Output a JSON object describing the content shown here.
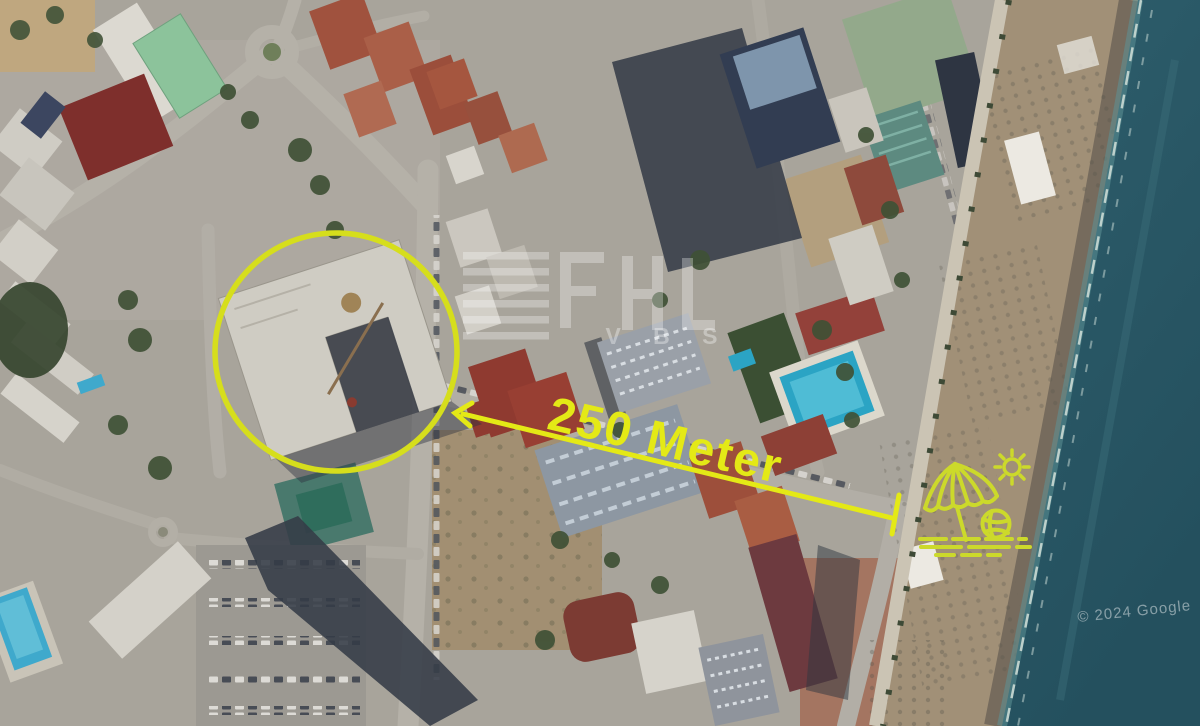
{
  "map": {
    "type": "satellite-aerial-photo",
    "description": "Aerial view of a coastal town: urban blocks left, beach and sea on the right",
    "annotations": {
      "distance_label": "250 Meter",
      "highlight_circle": {
        "purpose": "highlighted building under construction",
        "center_x": 336,
        "center_y": 352,
        "radius": 120
      },
      "beach_icons": [
        "umbrella-icon",
        "sun-icon",
        "beach-ball-icon",
        "sand-lines-icon"
      ],
      "watermark_small_text": "V B S",
      "copyright": "© 2024 Google"
    },
    "colors": {
      "annotation_yellow": "#e4e916",
      "circle_yellow": "#d6de1c",
      "icon_yellow": "#ccd92b",
      "ocean": "#2e5e6c",
      "ocean_deep": "#24505e",
      "surf": "#5d9196",
      "sand": "#a19077",
      "watermark_white": "#ffffff"
    }
  }
}
